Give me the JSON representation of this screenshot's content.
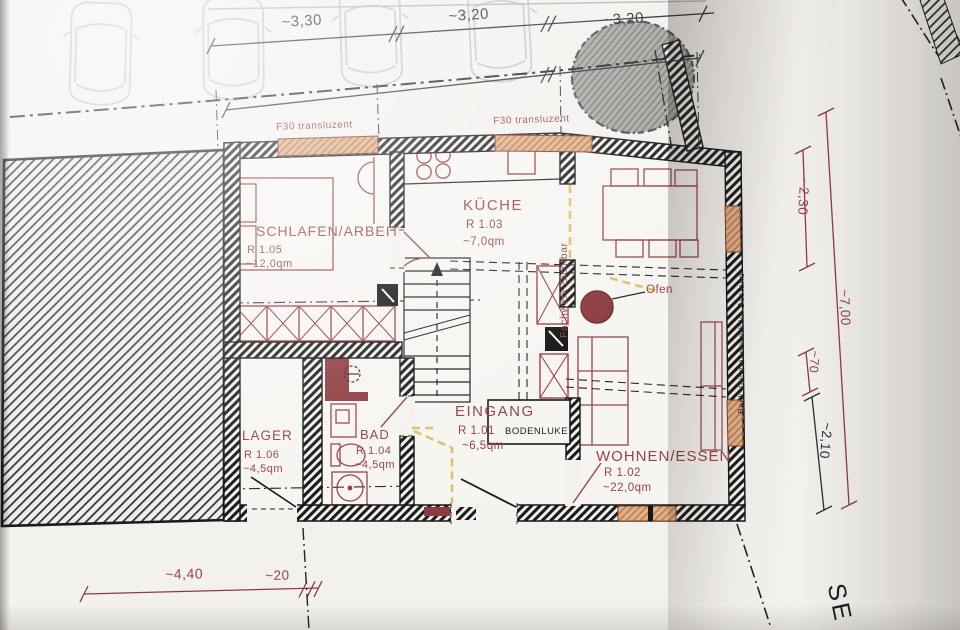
{
  "plan": {
    "rooms": [
      {
        "name": "SCHLAFEN/ARBEIT",
        "number": "R 1.05",
        "area": "~12,0qm"
      },
      {
        "name": "KÜCHE",
        "number": "R 1.03",
        "area": "~7,0qm"
      },
      {
        "name": "WOHNEN/ESSEN",
        "number": "R 1.02",
        "area": "~22,0qm"
      },
      {
        "name": "EINGANG",
        "number": "R 1.01",
        "area": "~6,5qm"
      },
      {
        "name": "BAD",
        "number": "R 1.04",
        "area": "~4,5qm"
      },
      {
        "name": "LAGER",
        "number": "R 1.06",
        "area": "~4,5qm"
      }
    ],
    "annotations": {
      "window_fire_rating_left": "F30 transluzent",
      "window_fire_rating_right": "F30 transluzent",
      "timber_wall": "Fachwerk Sichtbar",
      "existing_wall": "Backsteinmauerwerk im Bestand",
      "stove": "Ofen",
      "floor_hatch": "BODENLUKE",
      "street_name_partial": "SE"
    },
    "dimensions": {
      "top": [
        "~3,30",
        "~3,20",
        "~3,20"
      ],
      "right": [
        "~2,30",
        "~7,00",
        "~70",
        "~2,10"
      ],
      "bottom": [
        "~4,40",
        "~20"
      ]
    },
    "colors": {
      "annotation_red": "#974349",
      "dimension_red": "#8e3b40",
      "window_tan": "#e0b28a",
      "timber_yellow": "#dcc26a",
      "ink_black": "#1d1d1d"
    }
  }
}
